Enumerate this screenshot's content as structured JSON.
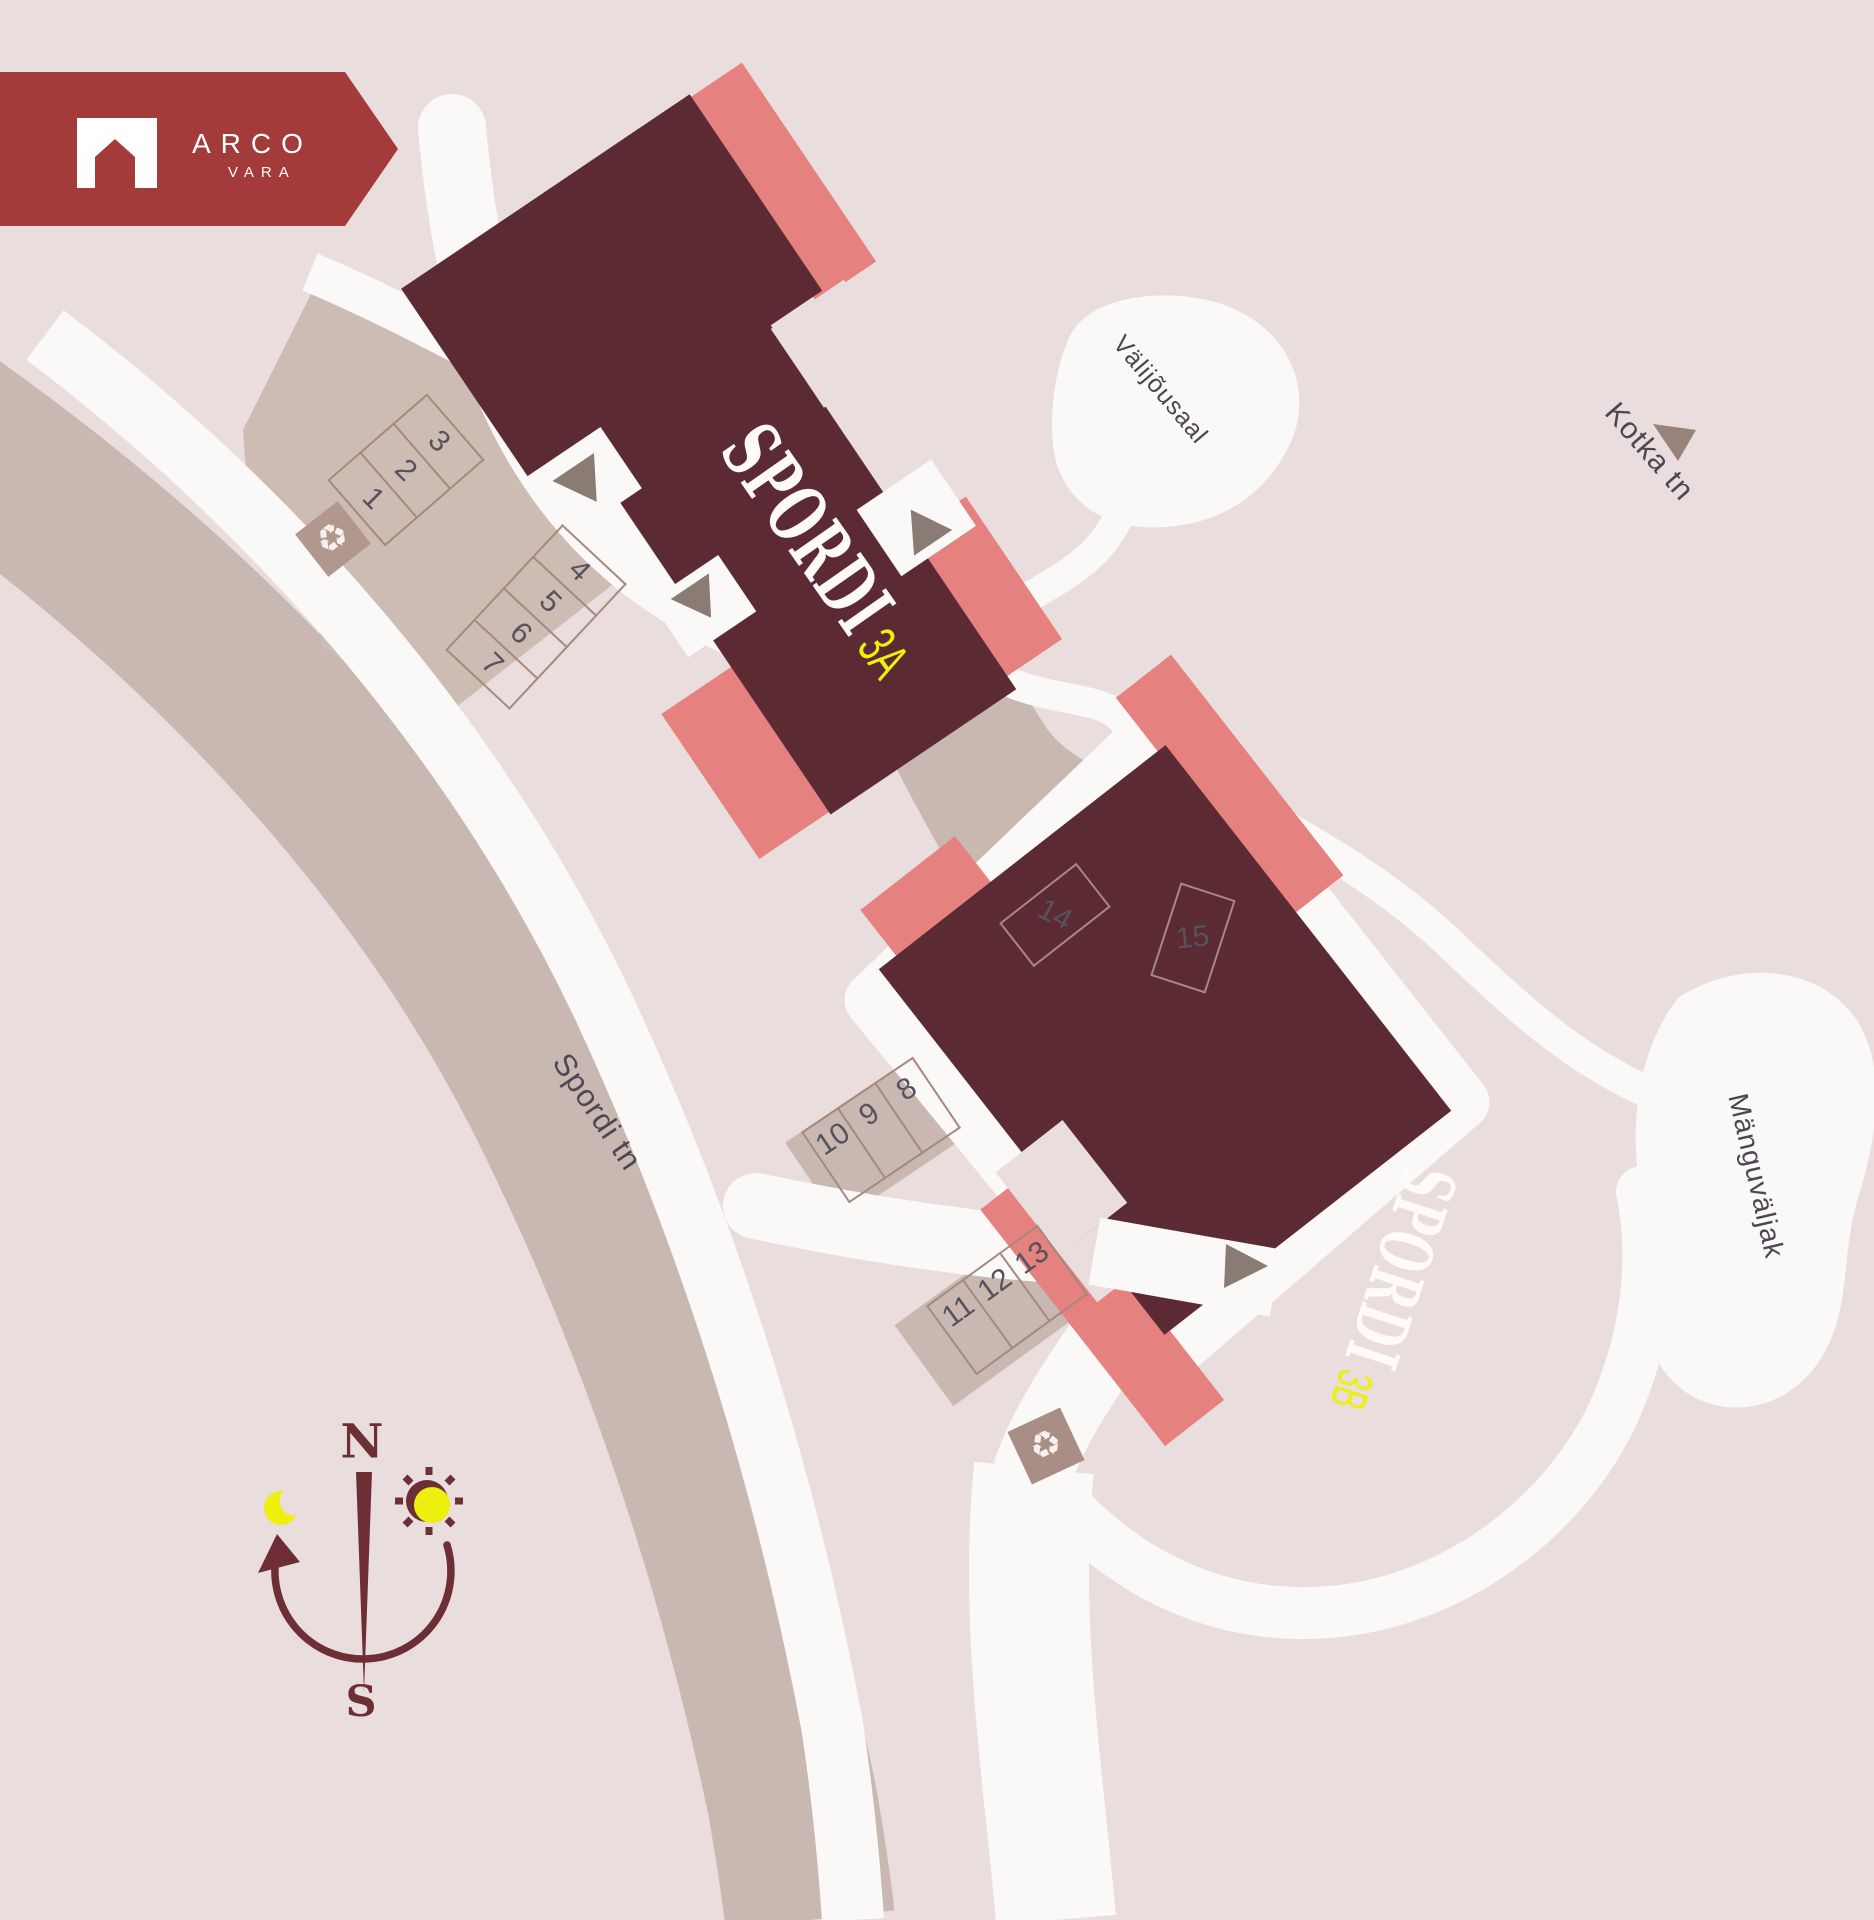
{
  "logo": {
    "brand": "ARCO",
    "sub": "VARA"
  },
  "buildings": {
    "a": {
      "name": "SPORDI",
      "unit": "3A"
    },
    "b": {
      "name": "SPORDI",
      "unit": "3B"
    }
  },
  "labels": {
    "street_main": "Spordi tn",
    "street_secondary": "Kotka tn",
    "outdoor_gym": "Välijõusaal",
    "playground": "Mänguväljak"
  },
  "parking": {
    "row_a": [
      "1",
      "2",
      "3"
    ],
    "row_b": [
      "7",
      "6",
      "5",
      "4"
    ],
    "row_c": [
      "10",
      "9",
      "8"
    ],
    "row_d": [
      "11",
      "12",
      "13"
    ],
    "spot_14": "14",
    "spot_15": "15"
  },
  "compass": {
    "north": "N",
    "south": "S"
  },
  "icons": {
    "recycle": "♻"
  },
  "colors": {
    "background": "#e9dedd",
    "building": "#5b2a33",
    "accent_salmon": "#e5827f",
    "brand_red": "#a23b3a",
    "highlight_yellow": "#edef0d",
    "street": "#c9b8b2",
    "path_white": "#fbf8f8",
    "compass": "#6e2e35",
    "number_gray": "#56525e"
  }
}
